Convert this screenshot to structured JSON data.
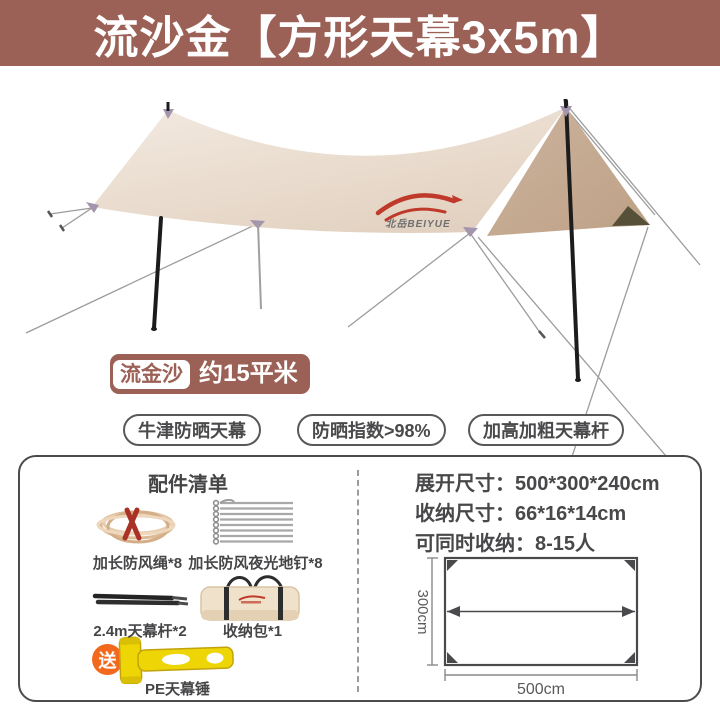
{
  "banner": {
    "title": "流沙金【方形天幕3x5m】",
    "bg_color": "#9c6156"
  },
  "product": {
    "brand_logo_text": "北岳BEIYUE",
    "area_badge": {
      "variant": "流金沙",
      "area": "约15平米"
    },
    "feature_pills": [
      {
        "label": "牛津防晒天幕"
      },
      {
        "label": "防晒指数>98%"
      },
      {
        "label": "加高加粗天幕杆"
      }
    ]
  },
  "info_panel": {
    "accessories": {
      "title": "配件清单",
      "items": [
        {
          "name": "加长防风绳*8",
          "icon": "rope-icon"
        },
        {
          "name": "加长防风夜光地钉*8",
          "icon": "stakes-icon"
        },
        {
          "name": "2.4m天幕杆*2",
          "icon": "poles-icon"
        },
        {
          "name": "收纳包*1",
          "icon": "storage-bag-icon"
        },
        {
          "name": "PE天幕锤",
          "icon": "hammer-icon",
          "gift_badge": "送"
        }
      ]
    },
    "specs": {
      "lines": [
        {
          "label": "展开尺寸：",
          "value": "500*300*240cm"
        },
        {
          "label": "收纳尺寸：",
          "value": "66*16*14cm"
        },
        {
          "label": "可同时收纳：",
          "value": "8-15人"
        }
      ],
      "diagram": {
        "height_label": "300cm",
        "width_label": "500cm"
      }
    }
  },
  "colors": {
    "banner_bg": "#9c6156",
    "brand_red": "#bf3a2b",
    "gift_orange": "#f2691d",
    "hammer_yellow": "#edd506",
    "tarp_front": "#e9dbce",
    "tarp_side": "#c3a78f",
    "dark_text": "#48484a"
  }
}
